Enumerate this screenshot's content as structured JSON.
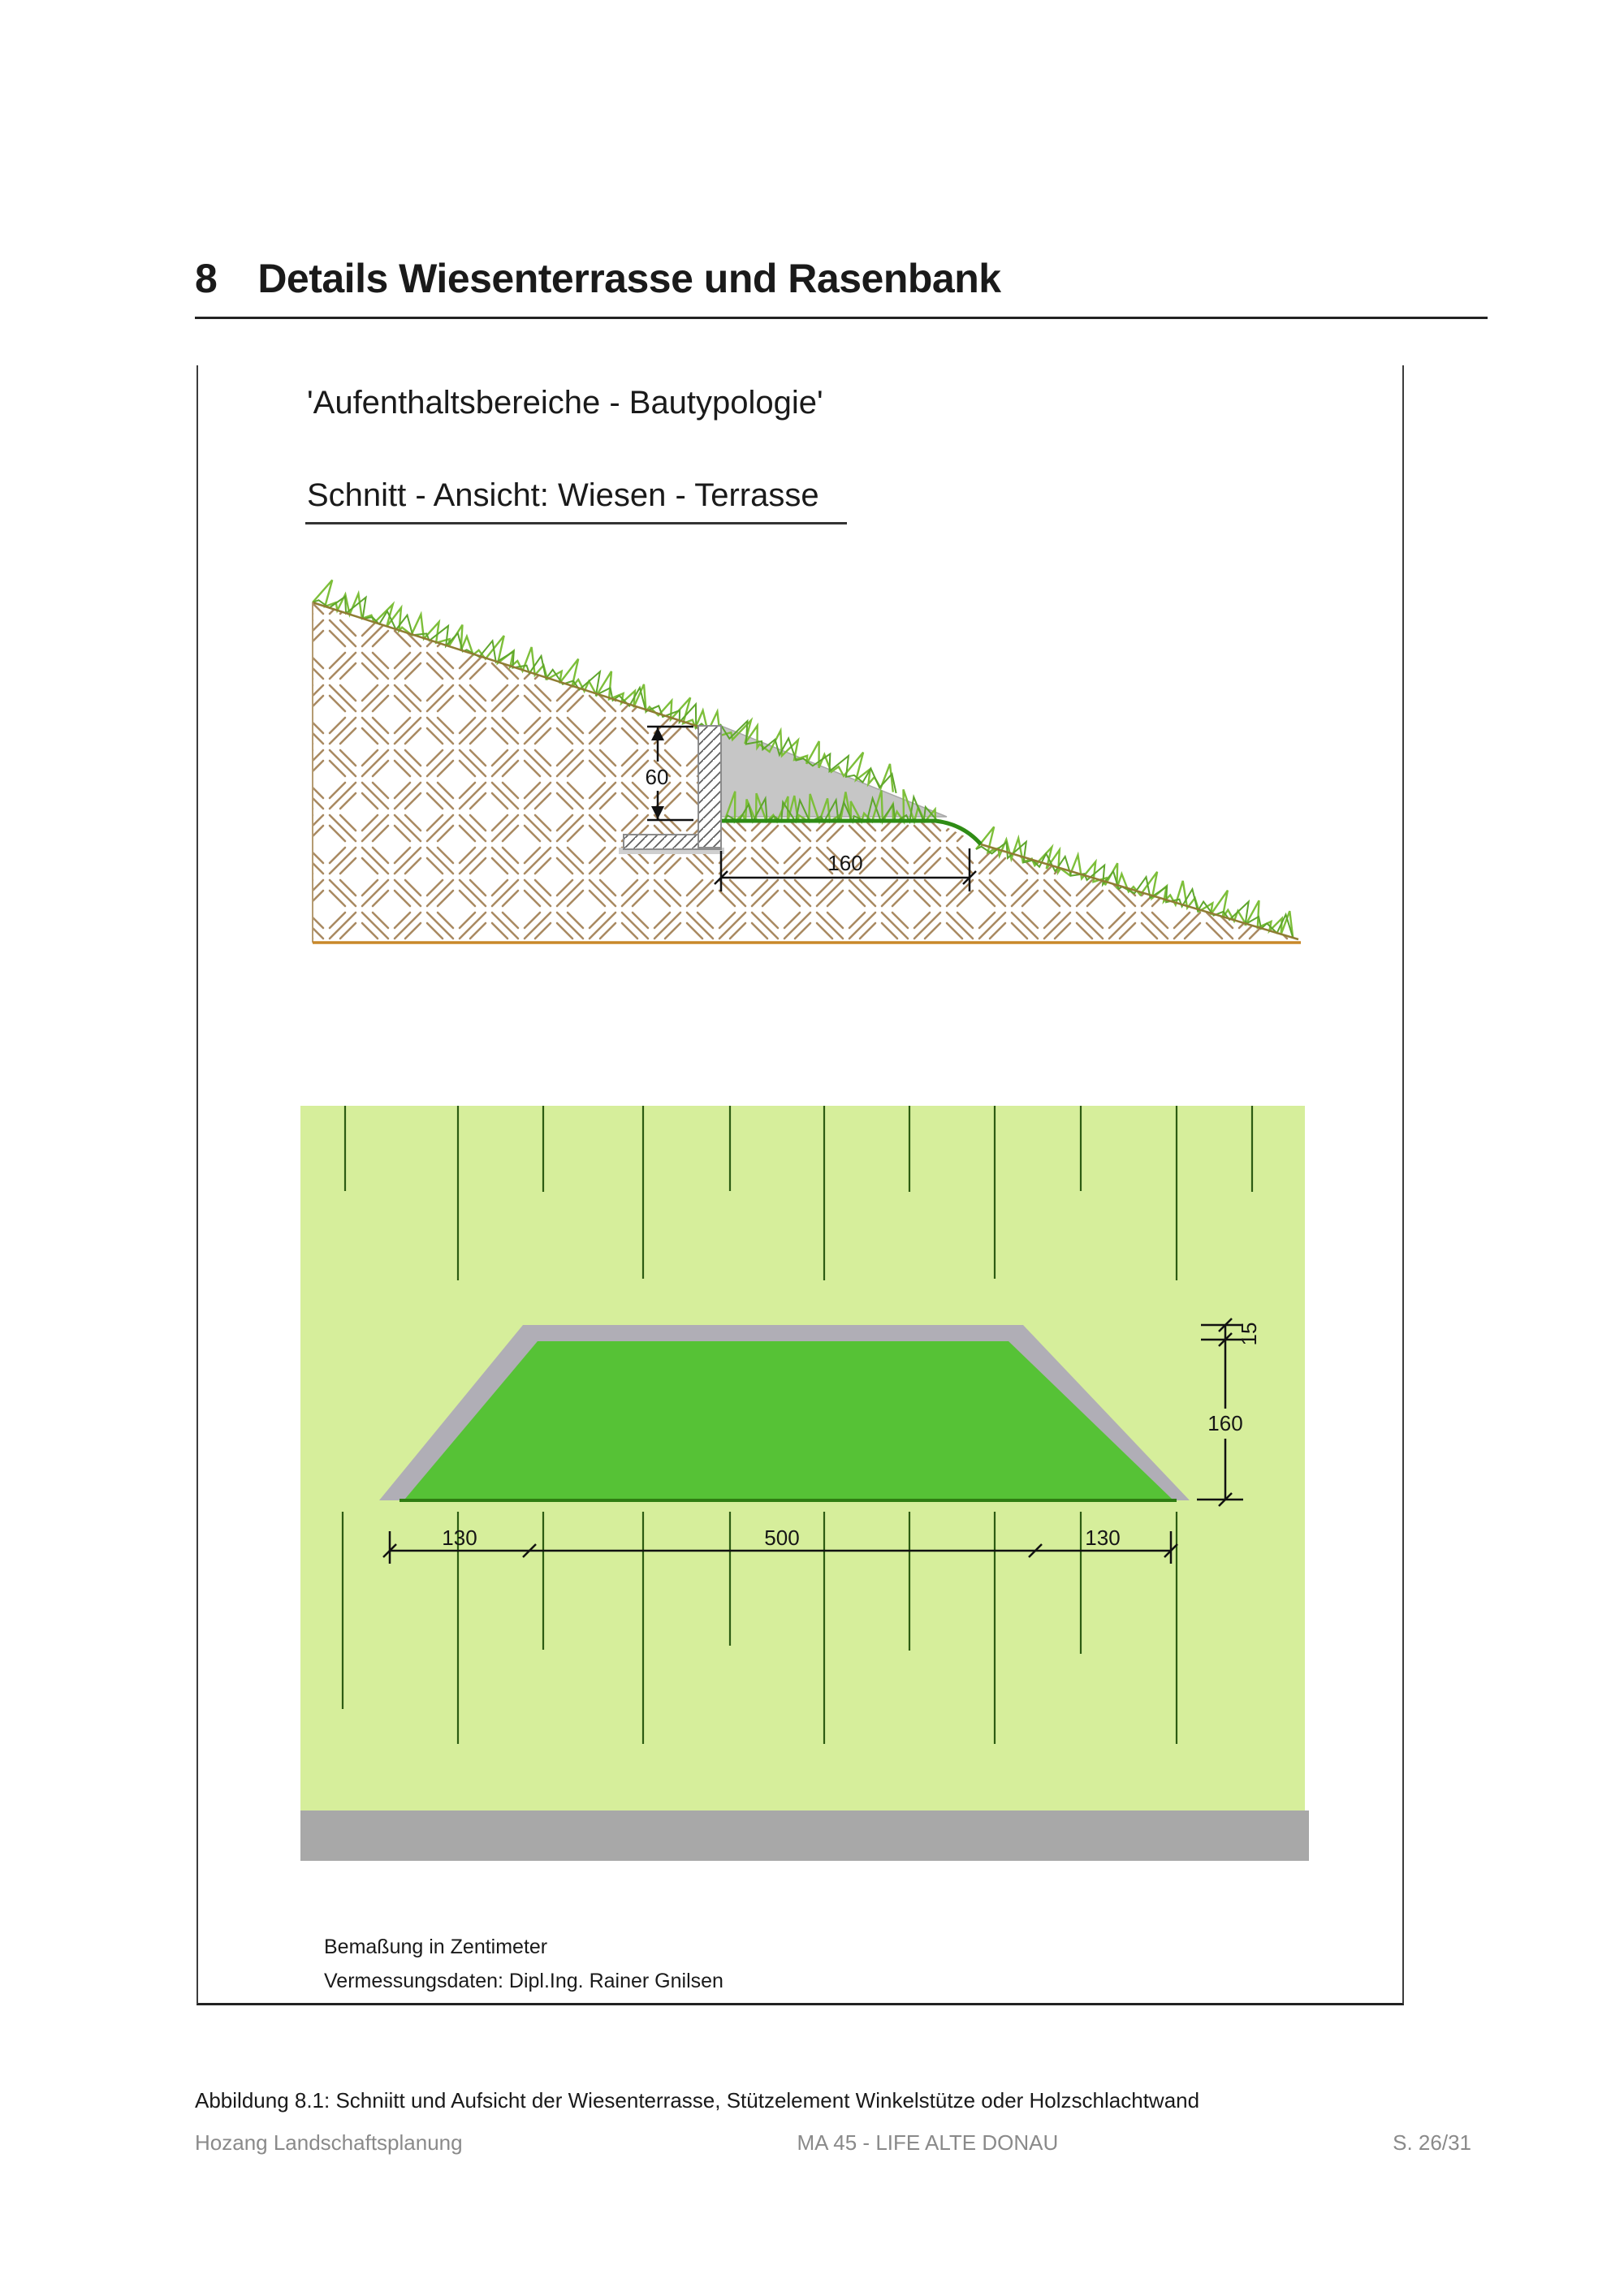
{
  "page": {
    "heading_number": "8",
    "heading_title": "Details  Wiesenterrasse und Rasenbank",
    "caption": "Abbildung 8.1: Schniitt und Aufsicht der Wiesenterrasse, Stützelement Winkelstütze oder Holzschlachtwand",
    "footer": {
      "company": "Hozang Landschaftsplanung",
      "project": "MA 45 - LIFE ALTE DONAU",
      "page_number": "S. 26/31"
    }
  },
  "figure": {
    "subtitle": "'Aufenthaltsbereiche - Bautypologie'",
    "section_title": "Schnitt - Ansicht: Wiesen - Terrasse",
    "notes": [
      "Bemaßung in Zentimeter",
      "Vermessungsdaten: Dipl.Ing. Rainer Gnilsen"
    ],
    "cross_section": {
      "wall_height_cm": "60",
      "terrace_width_cm": "160"
    },
    "plan": {
      "edge_cm": "15",
      "depth_cm": "160",
      "left_cm": "130",
      "width_cm": "500",
      "right_cm": "130"
    },
    "colors": {
      "field_green": "#d6ee9b",
      "terrace_green": "#56c236",
      "band_gray": "#b0aeb6",
      "bar_gray": "#a8a8a8",
      "grass_light": "#7dbf3a",
      "grass_dark": "#5ea62c",
      "earth_hatch": "#a98a62",
      "ground_line": "#c8882a",
      "terrace_line": "#2f8c15",
      "mow_line": "#2d5c13"
    }
  }
}
